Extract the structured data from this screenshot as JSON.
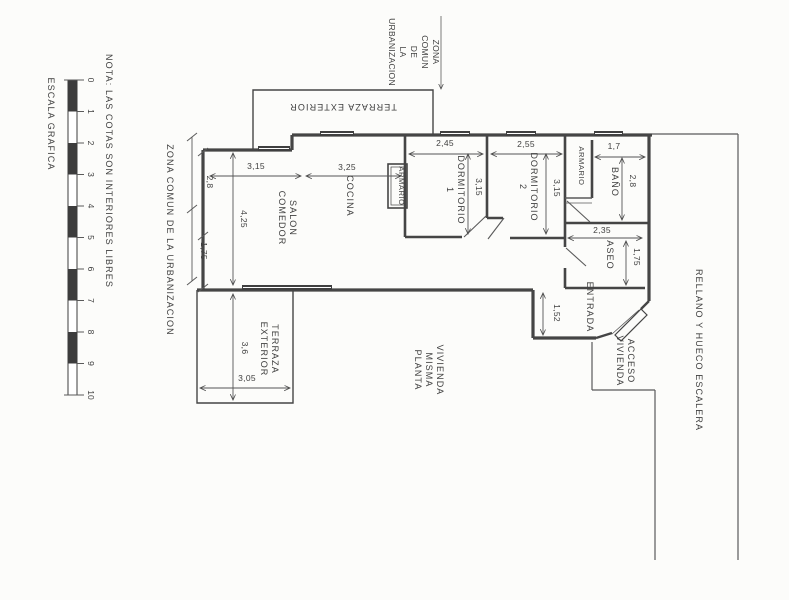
{
  "page": {
    "background": "#fcfcfa",
    "ink": "#3f3f3f"
  },
  "scale_bar": {
    "title": "ESCALA GRAFICA",
    "numbers": [
      "0",
      "1",
      "2",
      "3",
      "4",
      "5",
      "6",
      "7",
      "8",
      "9",
      "10"
    ]
  },
  "note": "NOTA: LAS COTAS SON INTERIORES LIBRES",
  "zona_comun_left": "ZONA COMUN DE LA URBANIZACION",
  "zona_comun_top": {
    "lines": [
      "ZONA",
      "COMUN",
      "DE",
      "LA",
      "URBANIZACION"
    ]
  },
  "rooms": {
    "terraza_superior": "TERRAZA EXTERIOR",
    "salon_comedor": {
      "lines": [
        "SALON",
        "COMEDOR"
      ]
    },
    "cocina": "COCINA",
    "armario_dormitorio1": "ARMARIO",
    "dormitorio_1": {
      "lines": [
        "DORMITORIO",
        "1"
      ]
    },
    "dormitorio_2": {
      "lines": [
        "DORMITORIO",
        "2"
      ]
    },
    "armario_pasillo": "ARMARIO",
    "bano": "BAÑO",
    "aseo": "ASEO",
    "entrada": "ENTRADA",
    "terraza_exterior": {
      "lines": [
        "TERRAZA",
        "EXTERIOR"
      ]
    },
    "vivienda_misma_planta": {
      "lines": [
        "VIVIENDA",
        "MISMA",
        "PLANTA"
      ]
    },
    "acceso_vivienda": {
      "lines": [
        "ACCESO",
        "VIVIENDA"
      ]
    },
    "rellano": "RELLANO Y HUECO ESCALERA"
  },
  "dimensions": {
    "salon_ancho": "3,15",
    "salon_fondo": "4,25",
    "izquierda_superior": "2,8",
    "izquierda_inferior": "1,75",
    "cocina_ancho": "3,25",
    "dormitorio1_ancho": "2,45",
    "dormitorio1_fondo": "3,15",
    "dormitorio2_ancho": "2,55",
    "dormitorio2_fondo": "3,15",
    "bano_ancho": "1,7",
    "bano_fondo": "2,8",
    "aseo_ancho": "2,35",
    "aseo_fondo": "1,75",
    "entrada_fondo": "1,52",
    "terraza_fondo": "3,6",
    "terraza_ancho": "3,05"
  }
}
